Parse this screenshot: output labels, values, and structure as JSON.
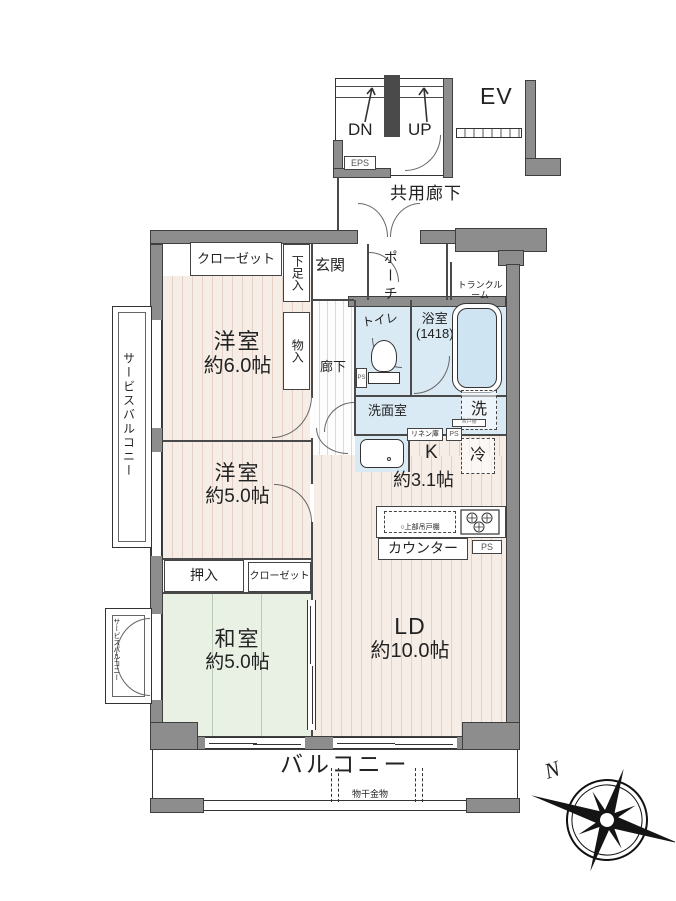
{
  "common": {
    "dn": "DN",
    "up": "UP",
    "ev": "EV",
    "eps": "EPS",
    "corridor": "共用廊下"
  },
  "entry": {
    "closet": "クローゼット",
    "shoebox": "下足入",
    "genkan": "玄関",
    "porch": "ポーチ",
    "trunk": "トランクルーム"
  },
  "rooms": {
    "w1_name": "洋室",
    "w1_size": "約6.0帖",
    "w2_name": "洋室",
    "w2_size": "約5.0帖",
    "jp_name": "和室",
    "jp_size": "約5.0帖",
    "ld_name": "LD",
    "ld_size": "約10.0帖",
    "k_name": "K",
    "k_size": "約3.1帖",
    "hall": "廊下",
    "toilet": "トイレ",
    "bath_name": "浴室",
    "bath_size": "(1418)",
    "washroom": "洗面室",
    "storage": "物入",
    "oshiire": "押入",
    "closet2": "クローゼット",
    "washer": "洗",
    "fridge": "冷",
    "linen": "リネン庫",
    "tiny_shelf": "吊戸棚",
    "ps": "PS",
    "upper_cabinet": "○上部吊戸棚",
    "counter": "カウンター"
  },
  "balcony": {
    "label": "バルコニー",
    "hardware": "物干金物"
  },
  "service_balcony": {
    "label": "サービスバルコニー"
  },
  "compass": {
    "north": "N"
  },
  "colors": {
    "wall": "#8d8d8d",
    "wet": "#d9eaf5",
    "wood": "#f7ede7",
    "tatami": "#e9f1e4"
  }
}
